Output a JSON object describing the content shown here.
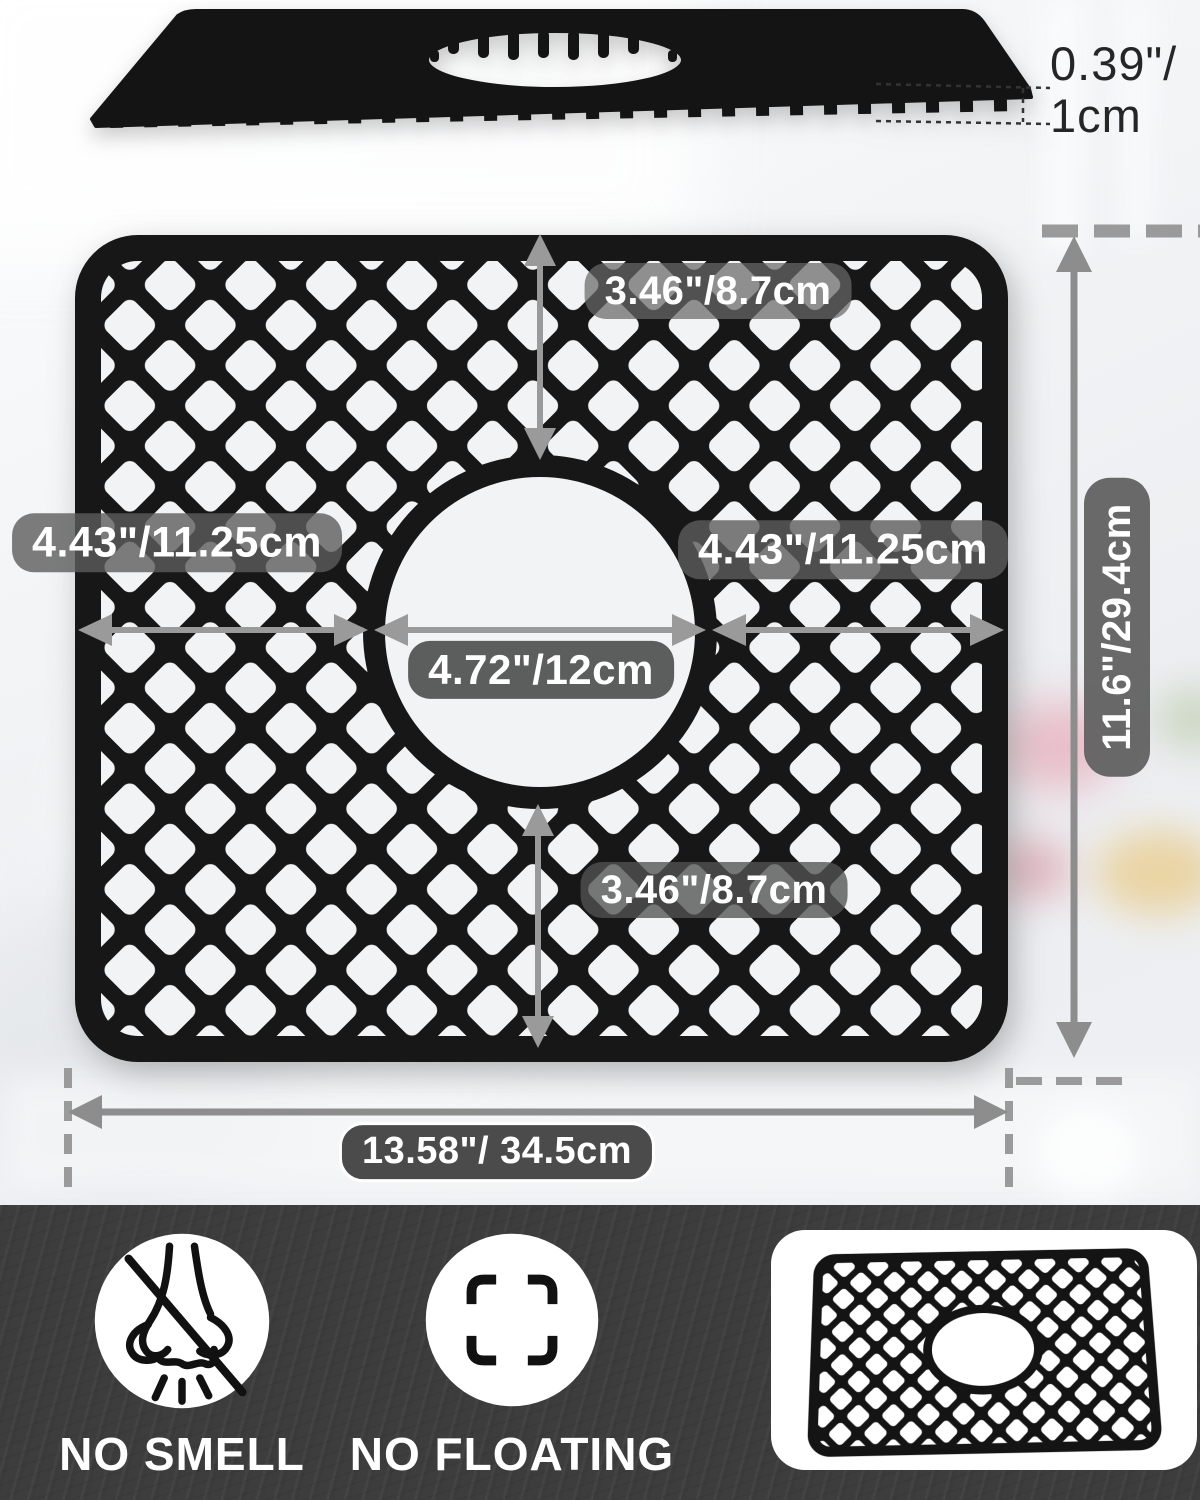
{
  "side_view": {
    "thickness_line1": "0.39\"/",
    "thickness_line2": "1cm"
  },
  "dimensions": {
    "hole_to_top": "3.46\"/8.7cm",
    "left_of_hole": "4.43\"/11.25cm",
    "right_of_hole": "4.43\"/11.25cm",
    "hole_diameter": "4.72\"/12cm",
    "hole_to_bottom": "3.46\"/8.7cm",
    "overall_height": "11.6\"/29.4cm",
    "overall_width": "13.58\"/ 34.5cm"
  },
  "band": {
    "features": [
      {
        "icon": "no-smell-icon",
        "label": "NO SMELL"
      },
      {
        "icon": "no-floating-icon",
        "label": "NO FLOATING"
      },
      {
        "icon": "product-thumbnail",
        "label": ""
      }
    ]
  },
  "colors": {
    "mat_black": "#171717",
    "arrow_gray": "#979797",
    "dim_label_bg": "#5c5c5c",
    "band_bg": "#3d3d3d",
    "page_bg": "#eef0f2",
    "text_white": "#ffffff",
    "thickness_text": "#262626"
  }
}
